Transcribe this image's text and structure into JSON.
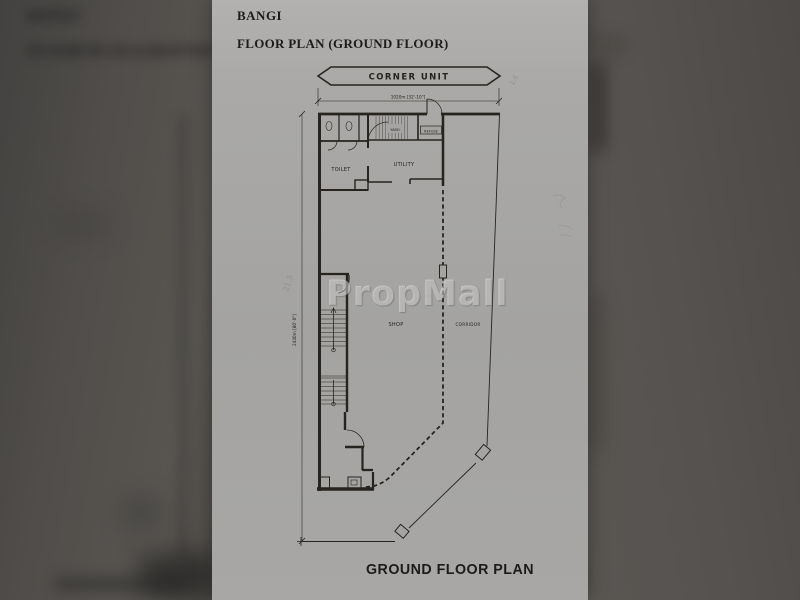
{
  "viewer": {
    "background_left": "#504d4a",
    "background_right": "#555250",
    "paper_color": "#a8a7a5",
    "line_color": "#27241f"
  },
  "document": {
    "title": "BANGI",
    "subtitle": "FLOOR PLAN (GROUND FLOOR)",
    "caption": "GROUND FLOOR PLAN",
    "watermark": "PropMall"
  },
  "plan": {
    "banner_label": "CORNER UNIT",
    "rooms": {
      "toilet": "TOILET",
      "yard": "YARD",
      "refuse": "REFUSE",
      "utility": "UTILITY",
      "shop": "SHOP",
      "corridor": "CORRIDOR"
    },
    "dimensions": {
      "width": "1020m [32'-10\"]",
      "depth": "2440m [80'-0\"]"
    },
    "pencil_notes": {
      "top_right": "1.6",
      "left_margin": "21.3"
    }
  }
}
